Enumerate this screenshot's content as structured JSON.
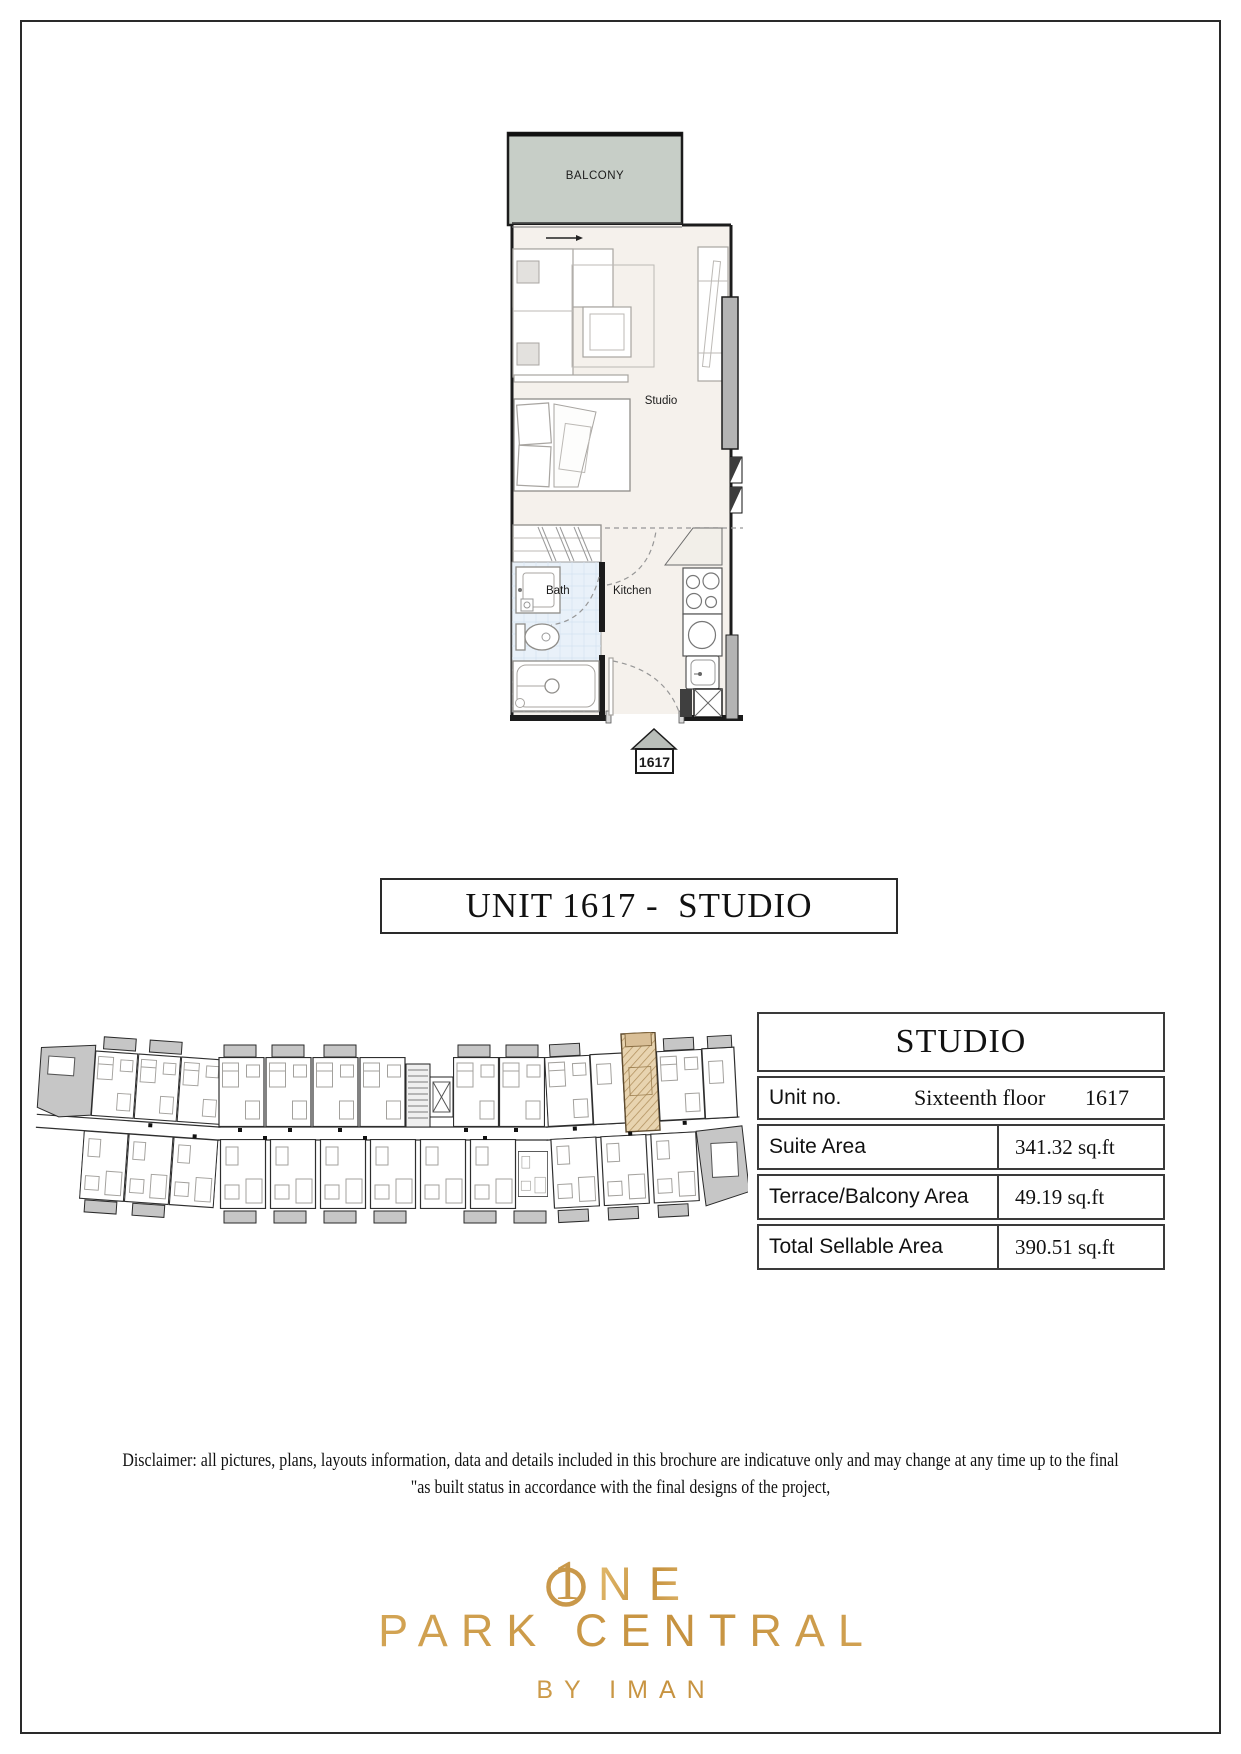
{
  "unit_plan": {
    "balcony_label": "BALCONY",
    "studio_label": "Studio",
    "bath_label": "Bath",
    "kitchen_label": "Kitchen",
    "unit_tag": "1617"
  },
  "title_banner": "UNIT 1617 -  STUDIO",
  "floor_plate": {
    "highlighted_unit": "1617"
  },
  "details_table": {
    "header": "STUDIO",
    "unit_no_label": "Unit no.",
    "floor_name": "Sixteenth floor",
    "unit_number": "1617",
    "rows": [
      {
        "label": "Suite Area",
        "value": "341.32 sq.ft"
      },
      {
        "label": "Terrace/Balcony Area",
        "value": "49.19 sq.ft"
      },
      {
        "label": "Total Sellable Area",
        "value": "390.51 sq.ft"
      }
    ]
  },
  "disclaimer": {
    "line1": "Disclaimer: all pictures, plans, layouts information, data and details included in this brochure are indicatuve only and may change at any time up to the final",
    "line2": "\"as built status in accordance with the final designs of the project,"
  },
  "logo": {
    "numeral": "1",
    "wordmark_suffix": "NE",
    "name": "PARK CENTRAL",
    "byline": "BY IMAN",
    "gold": "#cf9e52"
  },
  "colors": {
    "balcony_fill": "#c7cec7",
    "interior_fill": "#f5f1ec",
    "bath_tile": "#e9f1f9",
    "highlight_fill": "#e8d4b0",
    "plate_grey": "#c6c6c6"
  }
}
